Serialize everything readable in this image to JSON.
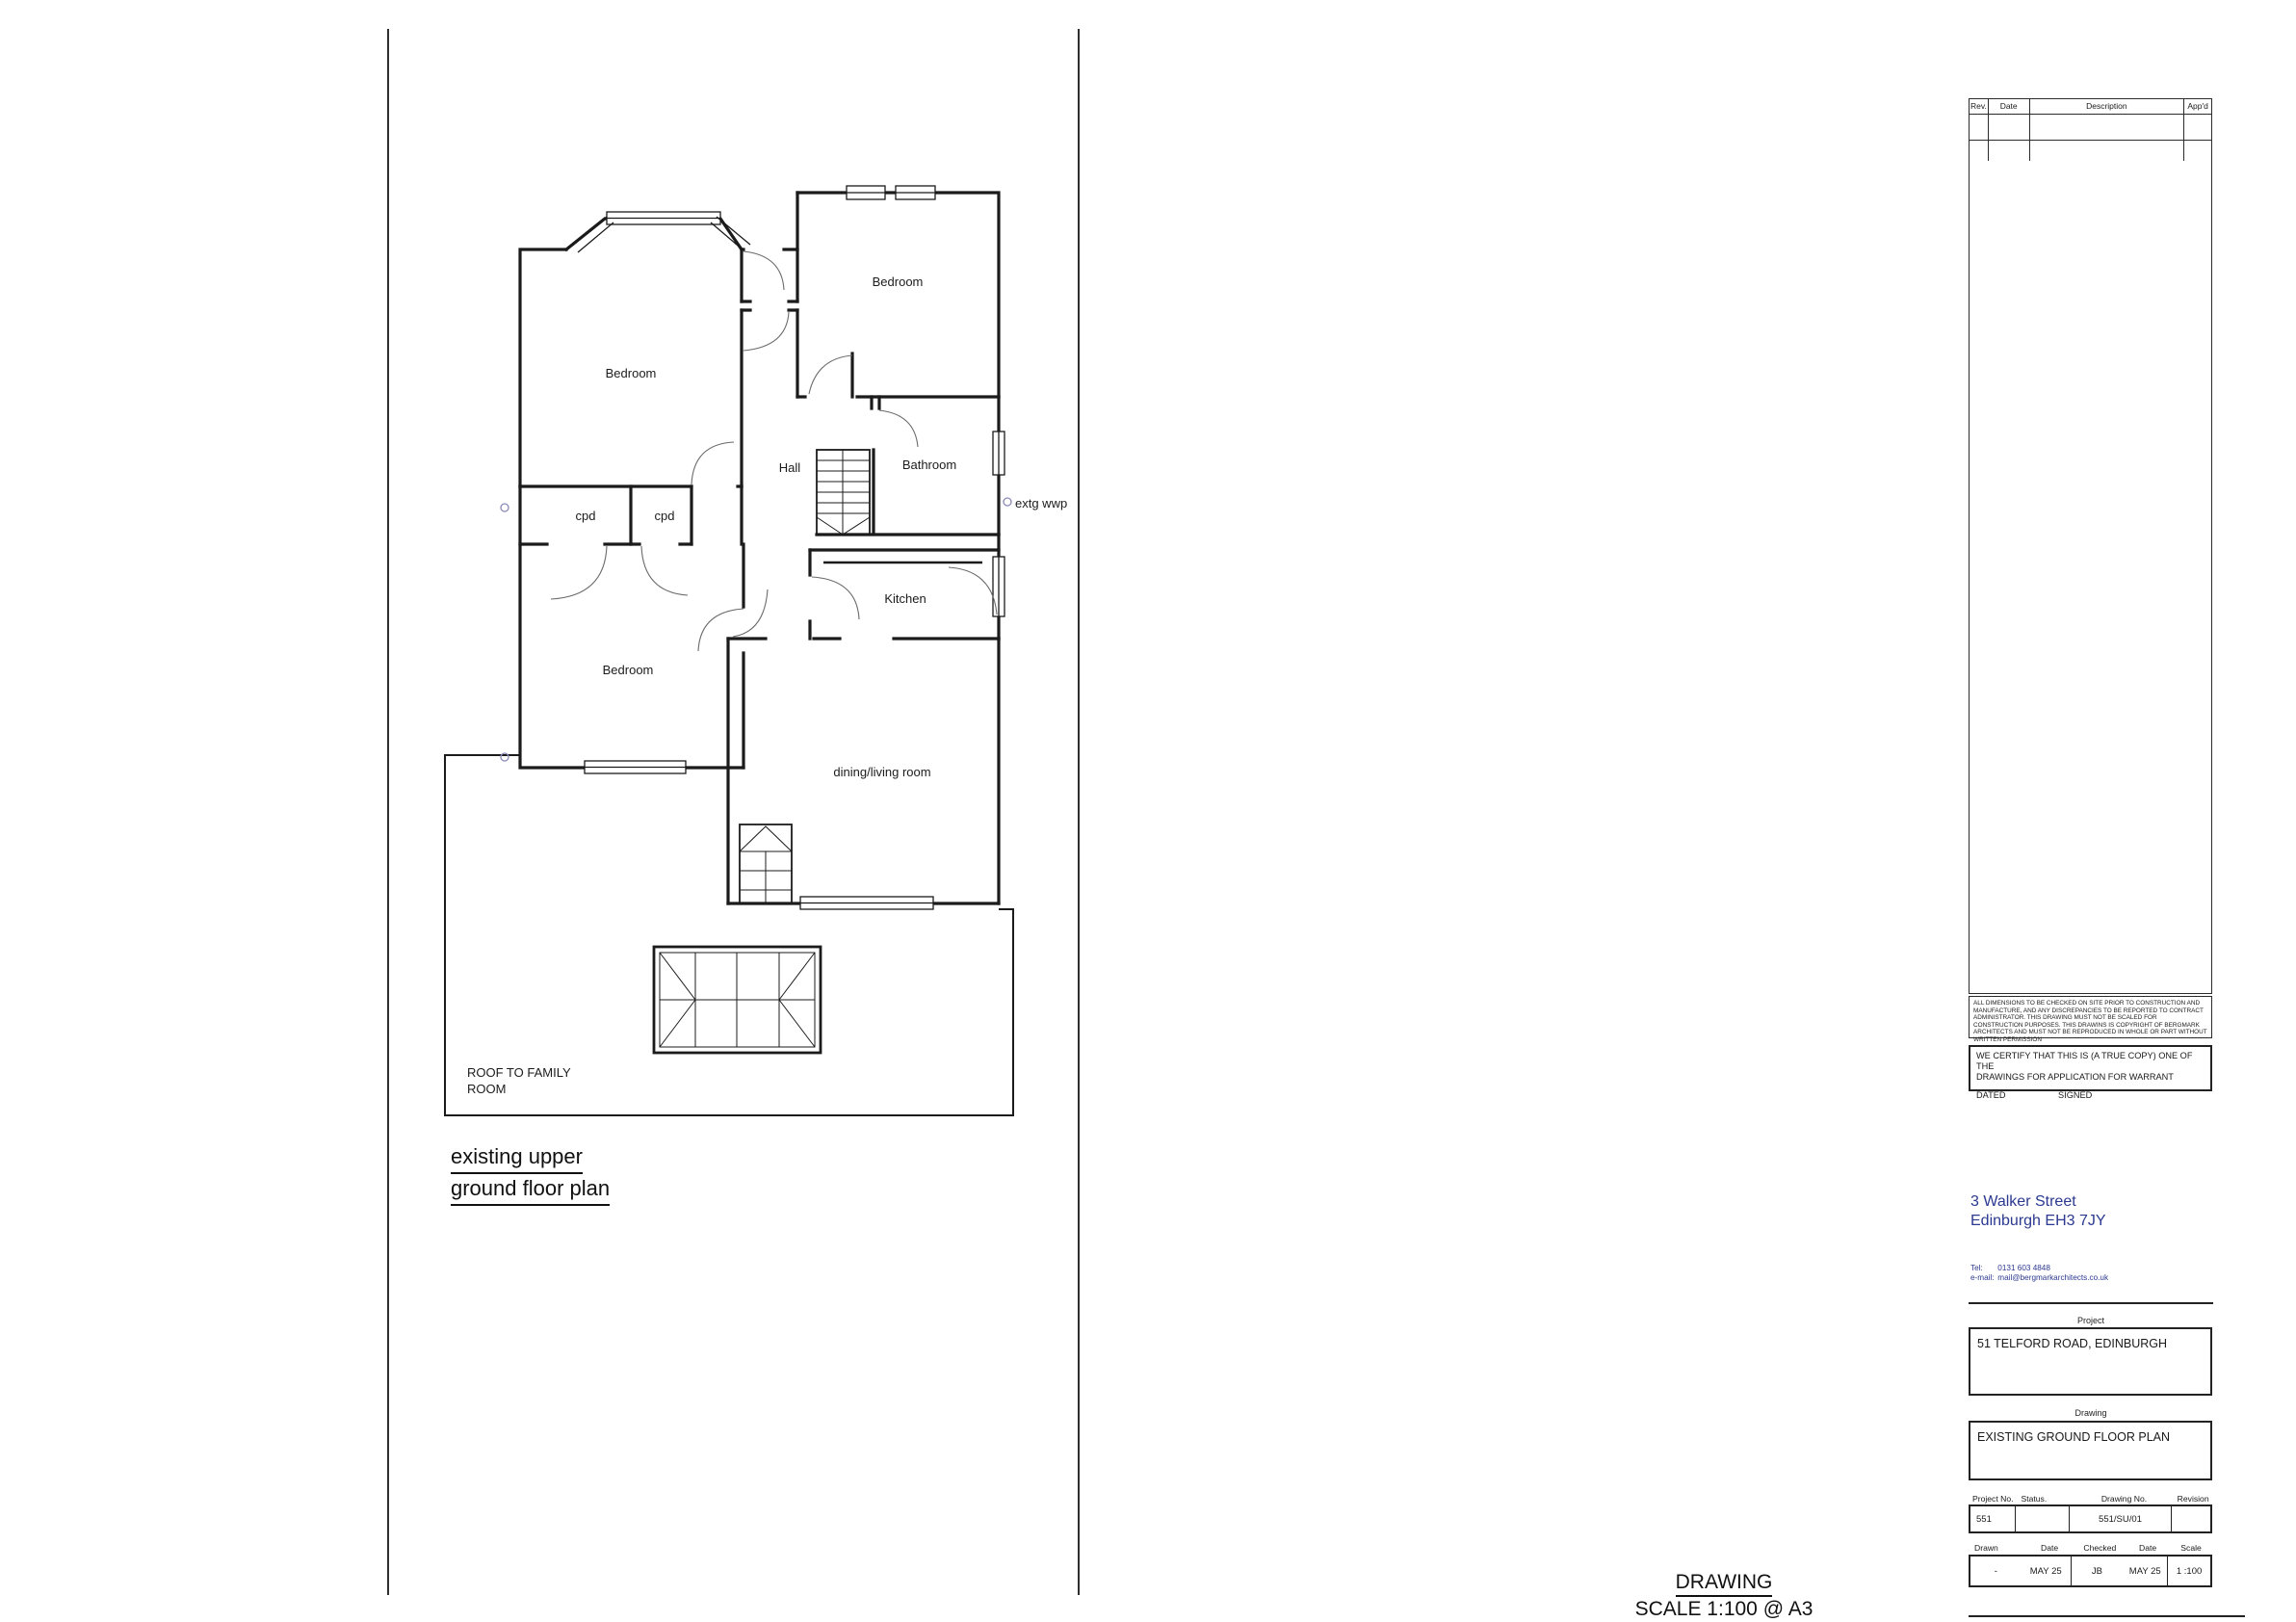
{
  "plan": {
    "title_line1": "existing upper",
    "title_line2": "ground floor plan",
    "labels": {
      "bedroom_top_left": "Bedroom",
      "bedroom_top_right": "Bedroom",
      "bedroom_lower": "Bedroom",
      "hall": "Hall",
      "bathroom": "Bathroom",
      "cpd_1": "cpd",
      "cpd_2": "cpd",
      "kitchen": "Kitchen",
      "dining": "dining/living room",
      "extg_wwp": "extg wwp",
      "roof_note_line1": "ROOF TO FAMILY",
      "roof_note_line2": "ROOM"
    }
  },
  "footer": {
    "line1": "DRAWING",
    "line2": "SCALE 1:100 @ A3"
  },
  "title_block": {
    "revision_table": {
      "headers": [
        "Rev.",
        "Date",
        "Description",
        "App'd"
      ]
    },
    "disclaimer": "ALL DIMENSIONS TO BE CHECKED ON SITE PRIOR TO CONSTRUCTION AND MANUFACTURE, AND ANY DISCREPANCIES TO BE REPORTED TO CONTRACT ADMINISTRATOR. THIS DRAWING MUST NOT BE SCALED FOR CONSTRUCTION PURPOSES. THIS DRAWINS IS COPYRIGHT OF BERGMARK ARCHITECTS AND MUST NOT BE REPRODUCED IN WHOLE OR PART WITHOUT WRITTEN PERMISSION",
    "certificate": {
      "line1": "WE CERTIFY THAT THIS IS (A TRUE COPY) ONE OF THE",
      "line2": "DRAWINGS FOR APPLICATION FOR WARRANT",
      "dated_label": "DATED",
      "signed_label": "SIGNED"
    },
    "practice": {
      "address_line1": "3 Walker Street",
      "address_line2": "Edinburgh EH3 7JY",
      "tel_label": "Tel:",
      "tel_value": "0131 603 4848",
      "email_label": "e-mail:",
      "email_value": "mail@bergmarkarchitects.co.uk"
    },
    "project_label": "Project",
    "project_value": "51 TELFORD ROAD,  EDINBURGH",
    "drawing_label": "Drawing",
    "drawing_value": "EXISTING GROUND FLOOR PLAN",
    "fields": {
      "project_no_label": "Project No.",
      "project_no_value": "551",
      "status_label": "Status.",
      "status_value": "",
      "drawing_no_label": "Drawing No.",
      "drawing_no_value": "551/SU/01",
      "revision_label": "Revision",
      "revision_value": "",
      "drawn_label": "Drawn",
      "drawn_value": "-",
      "drawn_date_label": "Date",
      "drawn_date_value": "MAY 25",
      "checked_label": "Checked",
      "checked_value": "JB",
      "checked_date_label": "Date",
      "checked_date_value": "MAY 25",
      "scale_label": "Scale",
      "scale_value": "1 :100"
    }
  },
  "colors": {
    "ink": "#1a1a1a",
    "navy": "#2b3990"
  }
}
